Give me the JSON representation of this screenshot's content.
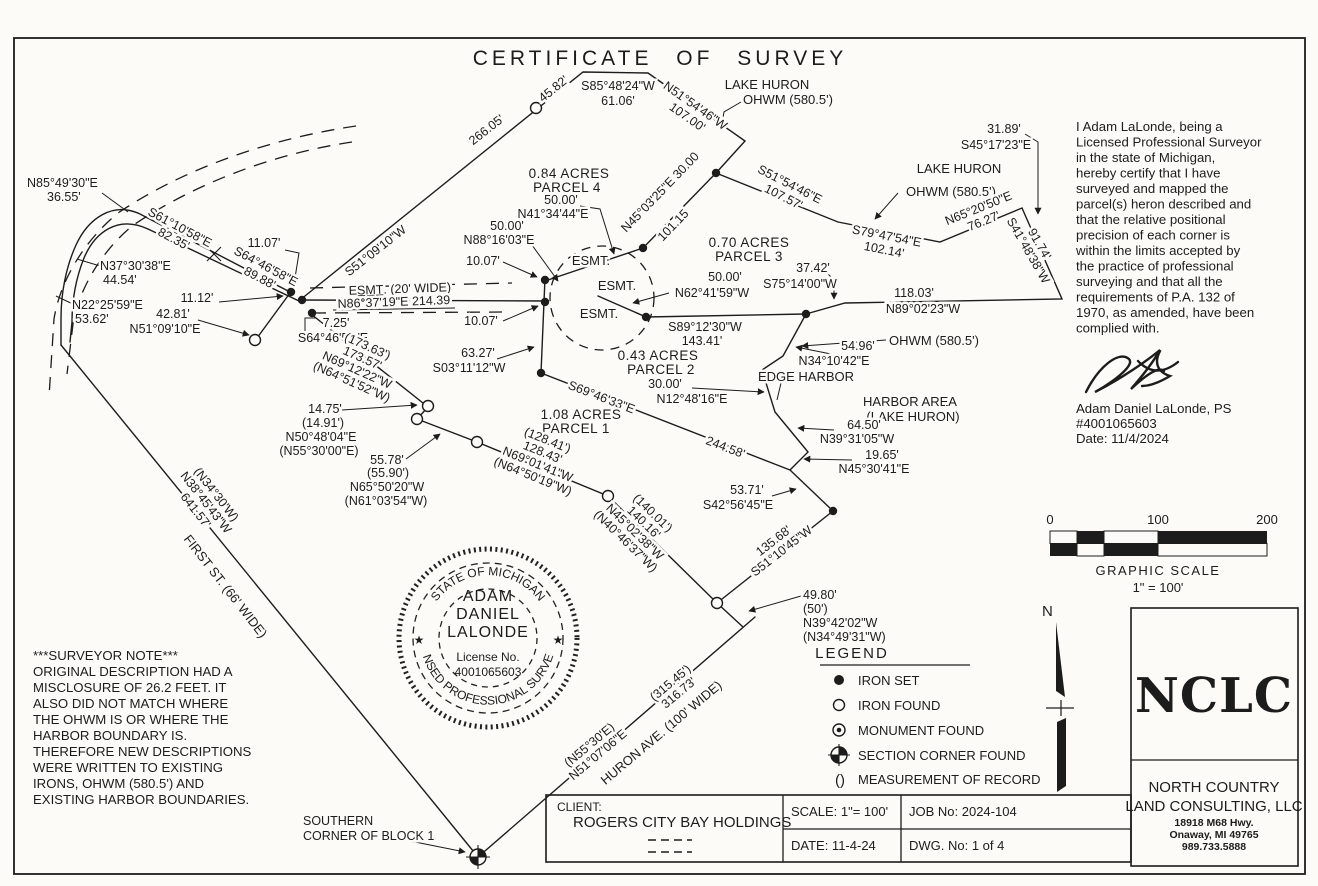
{
  "title": "CERTIFICATE OF SURVEY",
  "certification": {
    "lines": [
      "I Adam LaLonde, being a",
      "Licensed Professional Surveyor",
      "in the state of Michigan,",
      "hereby certify that I have",
      "surveyed and mapped the",
      "parcel(s) heron described and",
      "that the relative positional",
      "precision of each corner is",
      "within the limits accepted by",
      "the practice of professional",
      "surveying and that all the",
      "requirements of P.A. 132 of",
      "1970, as amended, have been",
      "complied with."
    ],
    "name": "Adam Daniel LaLonde, PS",
    "license": "#4001065603",
    "date": "Date: 11/4/2024"
  },
  "surveyor_note": {
    "lines": [
      "***SURVEYOR NOTE***",
      "ORIGINAL DESCRIPTION HAD A",
      "MISCLOSURE OF 26.2 FEET.  IT",
      "ALSO DID NOT MATCH WHERE",
      "THE OHWM IS OR WHERE THE",
      "HARBOR BOUNDARY IS.",
      "THEREFORE NEW DESCRIPTIONS",
      "WERE WRITTEN TO EXISTING",
      "IRONS, OHWM (580.5') AND",
      "EXISTING HARBOR BOUNDARIES."
    ]
  },
  "seal": {
    "arc_top": "STATE OF MICHIGAN",
    "arc_bottom": "LICENSED PROFESSIONAL SURVEYOR",
    "name1": "ADAM",
    "name2": "DANIEL",
    "name3": "LALONDE",
    "license_label": "License No.",
    "license_number": "4001065603",
    "star": "★"
  },
  "legend": {
    "title": "LEGEND",
    "items": [
      {
        "symbol": "iron-set",
        "label": "IRON SET"
      },
      {
        "symbol": "iron-found",
        "label": "IRON FOUND"
      },
      {
        "symbol": "monument-found",
        "label": "MONUMENT FOUND"
      },
      {
        "symbol": "section-corner-found",
        "label": "SECTION CORNER FOUND"
      },
      {
        "symbol": "parentheses",
        "symbol_text": "()",
        "label": "MEASUREMENT OF RECORD"
      }
    ]
  },
  "scale_bar": {
    "ticks": [
      "0",
      "100",
      "200"
    ],
    "label": "GRAPHIC SCALE",
    "ratio": "1\" = 100'"
  },
  "north_label": "N",
  "title_block": {
    "client_label": "CLIENT:",
    "client": "ROGERS CITY BAY HOLDINGS",
    "scale": "SCALE: 1\"= 100'",
    "job": "JOB No: 2024-104",
    "date": "DATE: 11-4-24",
    "dwg": "DWG. No: 1 of 4"
  },
  "firm": {
    "logo": "NCLC",
    "name1": "NORTH COUNTRY",
    "name2": "LAND CONSULTING, LLC",
    "address1": "18918 M68 Hwy.",
    "address2": "Onaway, MI 49765",
    "phone": "989.733.5888"
  },
  "anno": {
    "lake_huron_top": "LAKE HURON",
    "ohwm_top": "OHWM (580.5')",
    "s85_48_24w": "S85°48'24\"W",
    "d_61_06": "61.06'",
    "d_45_82": "45.82'",
    "d_266_05": "266.05'",
    "s51_09_10w": "S51°09'10\"W",
    "n51_54_46w": "N51°54'46\"W",
    "d_107_00": "107.00'",
    "s51_54_46e": "S51°54'46\"E",
    "d_107_57": "107.57'",
    "n45_03_25e": "N45°03'25\"E 30.00",
    "d_101_15": "101.15",
    "d_31_89": "31.89'",
    "s45_17_23e": "S45°17'23\"E",
    "lake_huron_right": "LAKE HURON",
    "ohwm_right": "OHWM (580.5')",
    "s79_47_54e": "S79°47'54\"E",
    "d_102_14": "102.14'",
    "n65_20_50e": "N65°20'50\"E",
    "d_76_27": "76.27'",
    "d_91_74": "91.74'",
    "s41_48_38w": "S41°48'38\"W",
    "d_118_03": "118.03'",
    "n89_02_23w": "N89°02'23\"W",
    "d_37_42": "37.42'",
    "s75_14_00w": "S75°14'00\"W",
    "d_50_00_b": "50.00'",
    "n62_41_59w": "N62°41'59\"W",
    "s89_12_30w": "S89°12'30\"W",
    "d_143_41": "143.41'",
    "d_54_96": "54.96'",
    "n34_10_42e": "N34°10'42\"E",
    "ohwm_mid": "OHWM (580.5')",
    "edge_harbor": "EDGE HARBOR",
    "harbor_area_1": "HARBOR AREA",
    "harbor_area_2": "(LAKE HURON)",
    "d_64_50": "64.50'",
    "n39_31_05w": "N39°31'05\"W",
    "d_19_65": "19.65'",
    "n45_30_41e": "N45°30'41\"E",
    "d_53_71": "53.71'",
    "s42_56_45e": "S42°56'45\"E",
    "parcel4_area": "0.84 ACRES",
    "parcel4_name": "PARCEL 4",
    "d_50_00_a": "50.00'",
    "n41_34_44e": "N41°34'44\"E",
    "d_50_00_c": "50.00'",
    "n88_16_03e": "N88°16'03\"E",
    "d_10_07_a": "10.07'",
    "d_10_07_b": "10.07'",
    "esmt_1": "ESMT.",
    "esmt_2": "ESMT.",
    "esmt_3": "ESMT.",
    "esmt_wide": "ES̲M̲T̲. (20' WIDE)",
    "n86_37_19e": "N86°37'19\"E  214.39",
    "parcel3_area": "0.70 ACRES",
    "parcel3_name": "PARCEL 3",
    "parcel2_area": "0.43 ACRES",
    "parcel2_name": "PARCEL 2",
    "d_30_00": "30.00'",
    "n12_48_16e": "N12°48'16\"E",
    "s69_46_33e": "S69°46'33\"E",
    "d_244_58": "244.58'",
    "parcel1_area": "1.08 ACRES",
    "parcel1_name": "PARCEL 1",
    "d_63_27": "63.27'",
    "s03_11_12w": "S03°11'12\"W",
    "d_11_07": "11.07'",
    "n85_49_30e": "N85°49'30\"E",
    "d_36_55": "36.55'",
    "s61_10_58e": "S61°10'58\"E",
    "d_82_35": "82.35'",
    "s64_46_58e_a": "S64°46'58\"E",
    "d_89_88": "89.88'",
    "n37_30_38e": "N37°30'38\"E",
    "d_44_54": "44.54'",
    "n22_25_59e": "N22°25'59\"E",
    "d_53_62": "53.62'",
    "d_11_12": "11.12'",
    "d_42_81": "42.81'",
    "n51_09_10e": "N51°09'10\"E",
    "d_7_25": "7.25'",
    "s64_46_58e_b": "S64°46'58\"E",
    "r_173_63": "(173.63')",
    "d_173_57": "173.57'",
    "n69_12_22w": "N69°12'22\"W",
    "r_n64_51_52w": "(N64°51'52\"W)",
    "d_14_75": "14.75'",
    "r_14_91": "(14.91')",
    "n50_48_04e": "N50°48'04\"E",
    "r_n55_30_00e": "(N55°30'00\"E)",
    "d_55_78": "55.78'",
    "r_55_90": "(55.90')",
    "n65_50_20w": "N65°50'20\"W",
    "r_n61_03_54w": "(N61°03'54\"W)",
    "r_128_41": "(128.41')",
    "d_128_43": "128.43'",
    "n69_01_41w": "N69°01'41\"W",
    "r_n64_50_19w": "(N64°50'19\"W)",
    "r_140_01": "(140.01')",
    "d_140_16": "140.16'",
    "n45_02_38w": "N45°02'38\"W",
    "r_n40_46_37w": "(N40°46'37\"W)",
    "d_135_68": "135.68'",
    "s51_10_45w": "S51°10'45\"W",
    "d_49_80": "49.80'",
    "r_50": "(50')",
    "n39_42_02w": "N39°42'02\"W",
    "r_n34_49_31w": "(N34°49'31\"W)",
    "r_315_45": "(315.45')",
    "d_316_73": "316.73'",
    "r_n55_30e": "(N55°30'E)",
    "n51_07_06e": "N51°07'06\"E",
    "huron_ave": "HURON AVE. (100' WIDE)",
    "first_st": "FIRST ST. (66' WIDE)",
    "r_n34_30w": "(N34°30'W)",
    "n38_45_43w": "N38°45'43\"W",
    "d_641_57": "641.57'",
    "southern_corner_1": "SOUTHERN",
    "southern_corner_2": "CORNER OF BLOCK 1"
  }
}
